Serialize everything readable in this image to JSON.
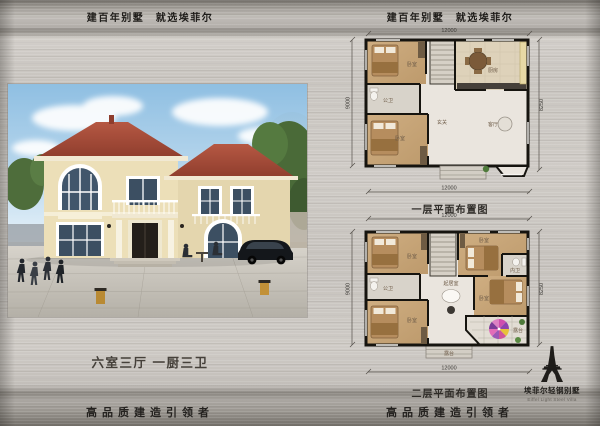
{
  "headers": {
    "left": "建百年别墅　就选埃菲尔",
    "right": "建百年别墅　就选埃菲尔"
  },
  "hero": {
    "spec": "六室三厅 一厨三卫",
    "image": "two-story-villa-exterior-rendering"
  },
  "footers": {
    "left": "高品质建造引领者",
    "right": "高品质建造引领者"
  },
  "logo": {
    "icon": "eiffel-tower-icon",
    "name_cn": "埃菲尔轻钢别墅",
    "name_en": "Eiffel Light Steel Villa"
  },
  "floor1": {
    "title": "一层平面布置图",
    "dims": {
      "top": "12000",
      "bottom": "12000",
      "left": "9000",
      "right": "8250"
    },
    "rooms": {
      "bedroom_tl": "卧室",
      "bath": "公卫",
      "bedroom_bl": "卧室",
      "foyer": "玄关",
      "living": "客厅",
      "kitchen": "厨房"
    }
  },
  "floor2": {
    "title": "二层平面布置图",
    "dims": {
      "top": "12000",
      "bottom": "12000",
      "left": "9000",
      "right": "8250"
    },
    "rooms": {
      "bedroom_tl": "卧室",
      "bath": "公卫",
      "bedroom_bl": "卧室",
      "bedroom_tr": "卧室",
      "ensuite": "内卫",
      "bedroom_br": "卧室",
      "family": "起居室",
      "terrace_side": "露台",
      "terrace_front": "露台"
    }
  },
  "colors": {
    "metal_light": "#cbc7c2",
    "metal_dark": "#716d67",
    "roof": "#a8503c",
    "wall_cream": "#ecdfb8",
    "wood_floor": "#c9a87c",
    "umbrella": "#cf4fae",
    "ink": "#211f1c"
  }
}
